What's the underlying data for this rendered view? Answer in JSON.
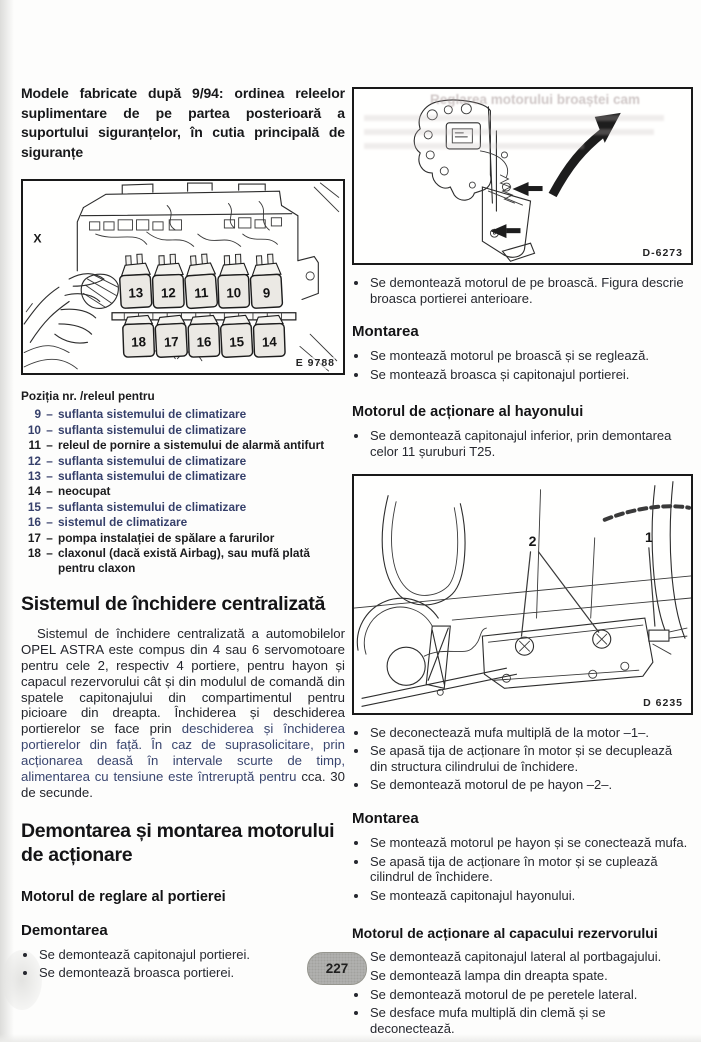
{
  "colors": {
    "ink": "#1c1c1e",
    "blue_text": "#36406b",
    "paper": "#fdfdfc"
  },
  "page": {
    "number": "227"
  },
  "left": {
    "intro": "Modele fabricate după 9/94: ordinea releelor suplimentare de pe partea posterioară a suportului siguranțelor, în cutia principală de siguranțe",
    "fuse": {
      "x_label": "X",
      "code": "E 9788",
      "top_row": [
        "13",
        "12",
        "11",
        "10",
        "9"
      ],
      "bottom_row": [
        "18",
        "17",
        "16",
        "15",
        "14"
      ]
    },
    "legend": {
      "title": "Poziția nr. /releul pentru",
      "sep": "–",
      "items": [
        {
          "num": "9",
          "text": "suflanta sistemului de climatizare"
        },
        {
          "num": "10",
          "text": "suflanta sistemului de climatizare"
        },
        {
          "num": "11",
          "text": "releul de pornire a sistemului de alarmă antifurt"
        },
        {
          "num": "12",
          "text": "suflanta sistemului de climatizare"
        },
        {
          "num": "13",
          "text": "suflanta sistemului de climatizare"
        },
        {
          "num": "14",
          "text": "neocupat"
        },
        {
          "num": "15",
          "text": "suflanta sistemului de climatizare"
        },
        {
          "num": "16",
          "text": "sistemul de climatizare"
        },
        {
          "num": "17",
          "text": "pompa instalației de spălare a farurilor"
        },
        {
          "num": "18",
          "text": "claxonul (dacă există Airbag), sau mufă plată pentru claxon"
        }
      ]
    },
    "closing": {
      "heading": "Sistemul de închidere centralizată",
      "para1": "Sistemul de închidere centralizată a automobilelor OPEL ASTRA este compus din 4 sau 6 servomotoare pentru cele 2, respectiv 4 portiere, pentru hayon și capacul rezervorului cât și din modulul de comandă din spatele capitonajului din compartimentul pentru picioare din dreapta. Închiderea și deschiderea portierelor se face prin ",
      "para2": "deschiderea și închiderea portierelor din față. În caz de suprasolicitare, prin acționarea deasă în intervale scurte de timp, alimentarea cu tensiune este întreruptă pentru ",
      "para3": "cca. 30 de secunde."
    },
    "demontare": {
      "heading_line1": "Demontarea și montarea motorului",
      "heading_line2": "de acționare",
      "sub": "Motorul de reglare al portierei",
      "sub2": "Demontarea",
      "bullets": [
        "Se demontează capitonajul portierei.",
        "Se demontează broasca portierei."
      ]
    }
  },
  "right": {
    "fig_top": {
      "code": "D-6273",
      "ghost": "Reglarea motorului broaștei cam"
    },
    "b1": [
      "Se demontează motorul de pe broască. Figura descrie broasca portierei anterioare."
    ],
    "m1": {
      "heading": "Montarea",
      "bullets": [
        "Se montează motorul pe broască și se reglează.",
        "Se montează broasca și capitonajul portierei."
      ]
    },
    "hayon": {
      "heading": "Motorul de acționare al hayonului",
      "bullets": [
        "Se demontează capitonajul inferior, prin demontarea celor 11 șuruburi T25."
      ]
    },
    "fig_mid": {
      "code": "D 6235",
      "callout1": "1",
      "callout2": "2"
    },
    "b2": [
      "Se deconectează mufa multiplă de la motor –1–.",
      "Se apasă tija de acționare în motor și se decuplează din structura cilindrului de închidere.",
      "Se demontează motorul de pe hayon –2–."
    ],
    "m2": {
      "heading": "Montarea",
      "bullets": [
        "Se montează motorul pe hayon și se conectează mufa.",
        "Se apasă tija de acționare în motor și se cuplează cilindrul de închidere.",
        "Se montează capitonajul hayonului."
      ]
    },
    "rezervor": {
      "heading": "Motorul de acționare al capacului rezervorului",
      "bullets": [
        "Se demontează capitonajul lateral al portbagajului.",
        "Se demontează lampa din dreapta spate.",
        "Se demontează motorul de pe peretele lateral.",
        "Se desface mufa multiplă din clemă și se deconectează."
      ]
    }
  }
}
